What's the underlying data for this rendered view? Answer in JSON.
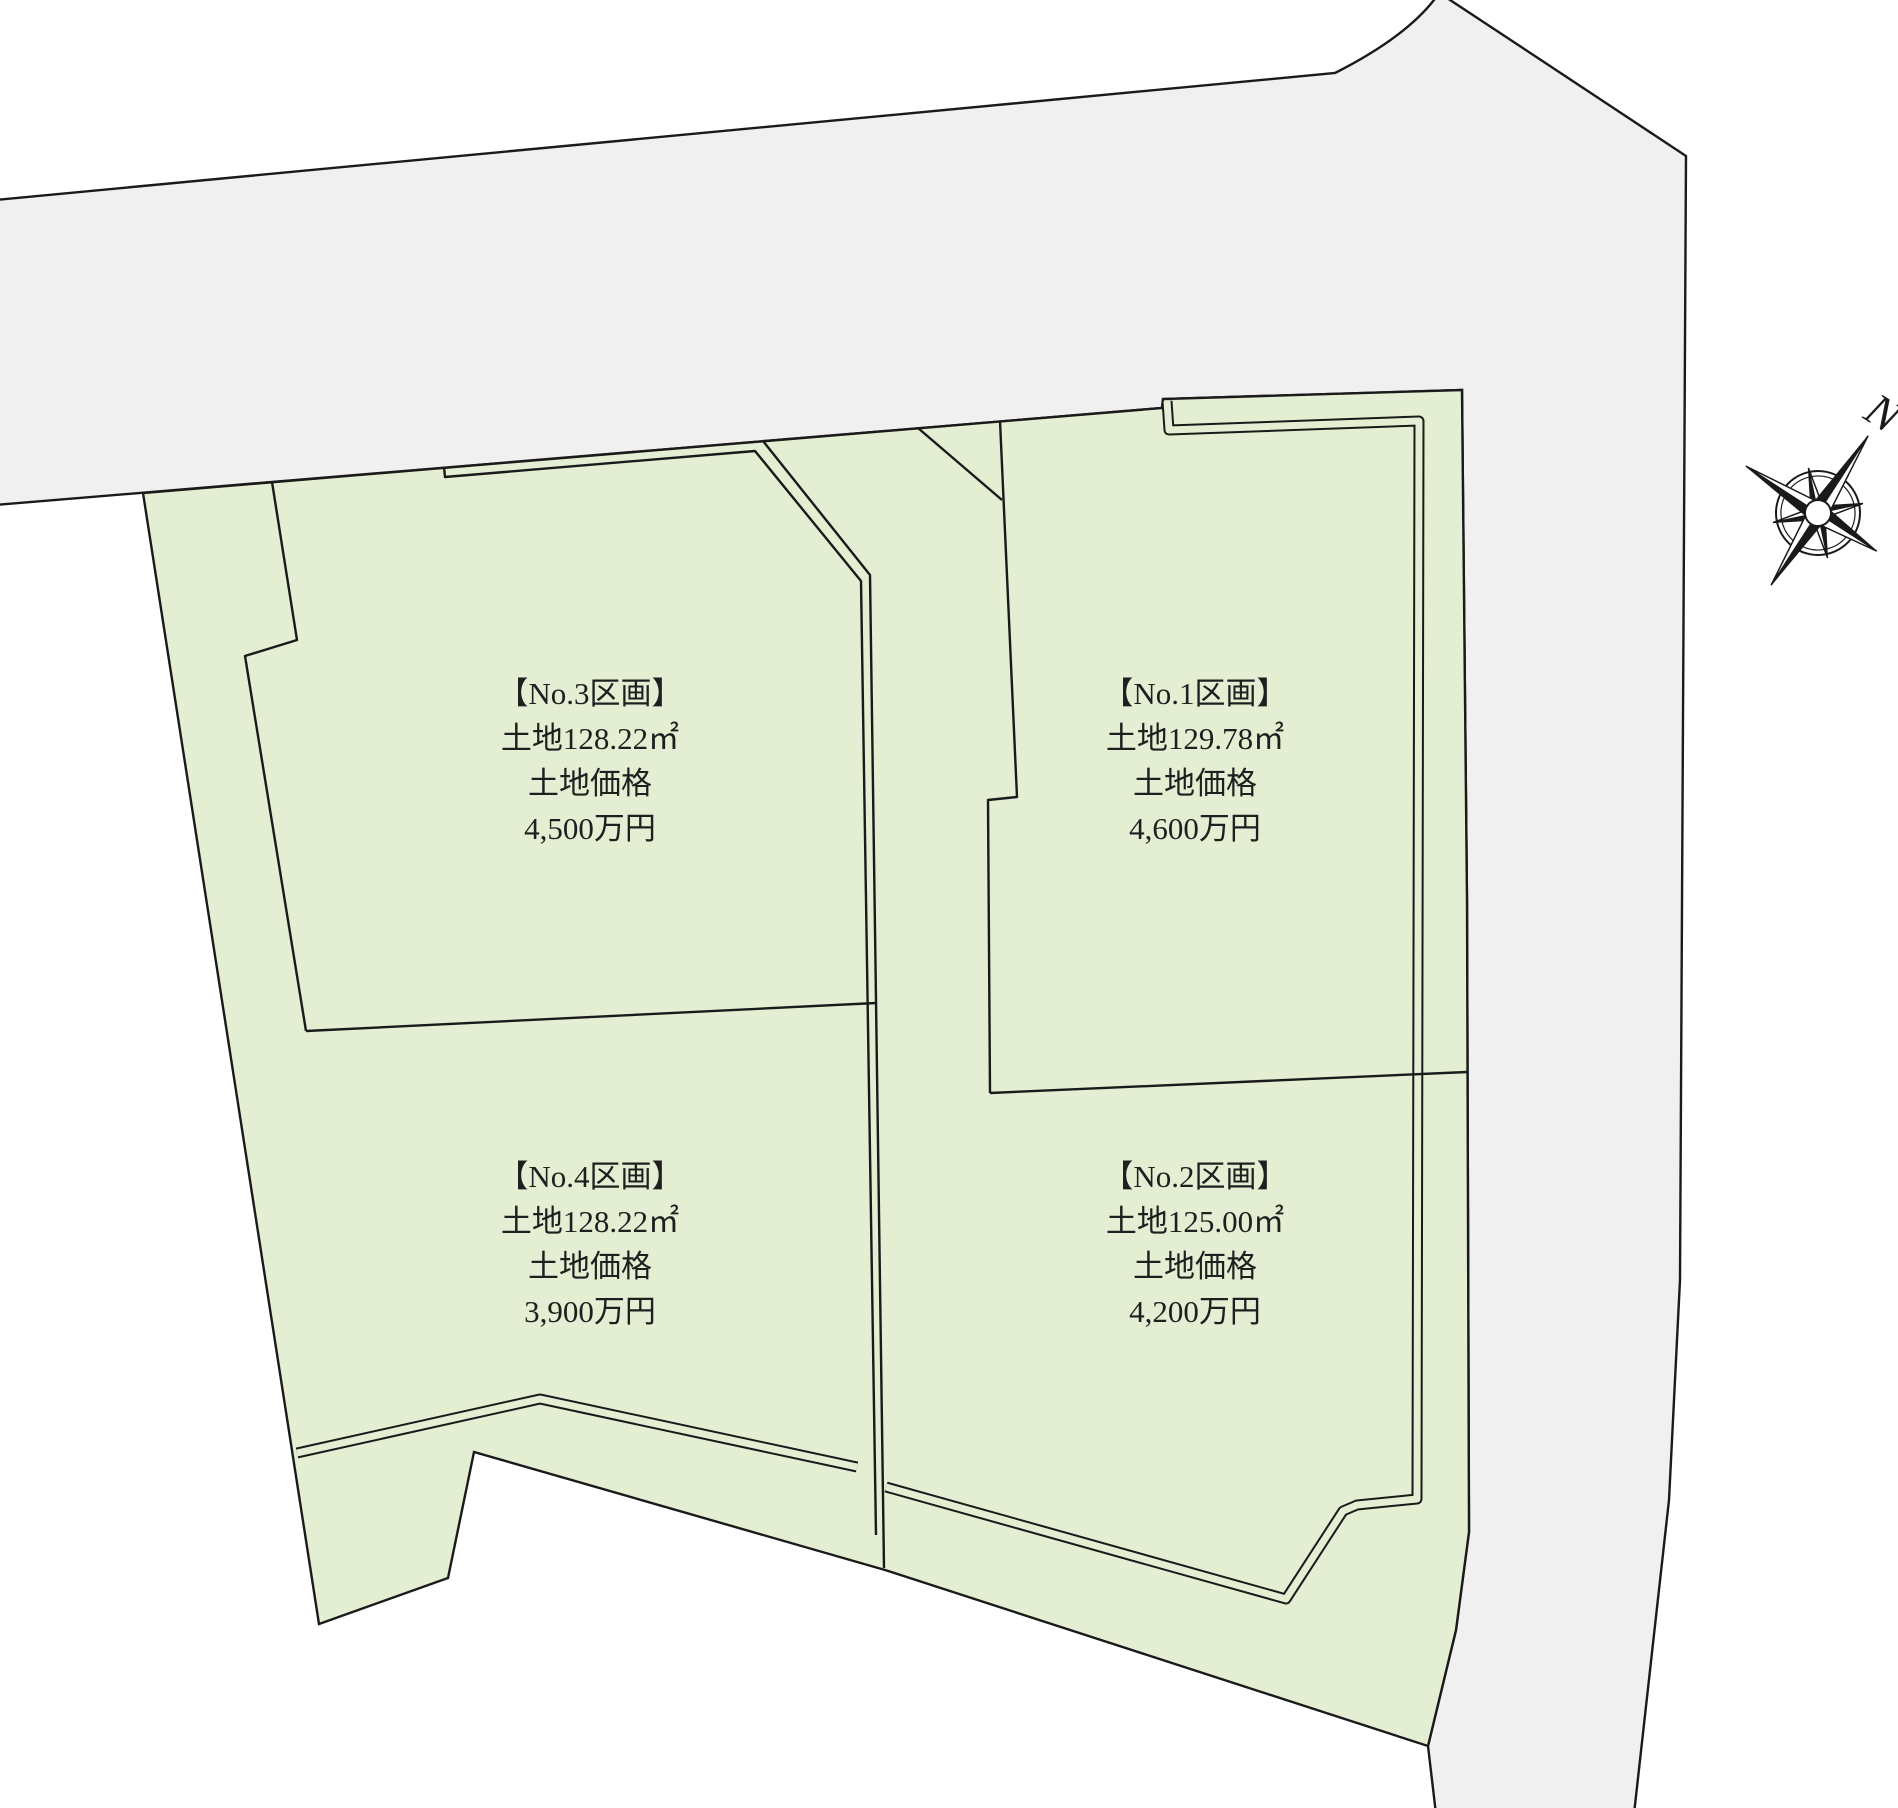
{
  "title": "土地区画図",
  "colors": {
    "road": "#f0f0f0",
    "parcel": "#e4eed2",
    "line": "#1a1a1a",
    "text": "#1f1f1f"
  },
  "compass": {
    "label": "N"
  },
  "parcels": [
    {
      "id": "no3",
      "name": "【No.3区画】",
      "area": "土地128.22㎡",
      "price_label": "土地価格",
      "price": "4,500万円"
    },
    {
      "id": "no1",
      "name": "【No.1区画】",
      "area": "土地129.78㎡",
      "price_label": "土地価格",
      "price": "4,600万円"
    },
    {
      "id": "no4",
      "name": "【No.4区画】",
      "area": "土地128.22㎡",
      "price_label": "土地価格",
      "price": "3,900万円"
    },
    {
      "id": "no2",
      "name": "【No.2区画】",
      "area": "土地125.00㎡",
      "price_label": "土地価格",
      "price": "4,200万円"
    }
  ],
  "geometry": {
    "road": "M -5 200 L 1335 73 Q 1408 36 1437 -4 L 1444 -4 L 1550 66 L 1686 156 L 1680 1280 L 1669 1500 L 1634 1814 L 1436 1814 L 1428 1746 L 1456 1630 L 1469 1532 L 1467 900 L 1462 390 L 1163 399 L 1162 408 L -5 505 Z",
    "estate": "M 143 493 L 319 1624 L 448 1578 L 474 1452 L 885 1570 L 1428 1746 L 1456 1630 L 1469 1532 L 1467 900 L 1462 390 L 1163 399 L 1162 408 Z",
    "plot3_left": "M 272 482 L 297 640 L 245 656 L 306 1031",
    "divider_3_4": "M 306 1031 L 876 1003",
    "mid_boundary": "M 763 441 L 870 575 L 884 1568",
    "setback_left": "M 444 467 L 445 477 L 755 451 L 861 581 L 876 1535",
    "plot1_left": "M 1000 421 L 1017 797 L 988 800 L 990 1093",
    "corner_cut": "M 918 428 L 1002 500",
    "divider_1_2": "M 990 1093 L 1467 1072",
    "setback_right": "M 1167 401 L 1169 430 L 1419 421 L 1417 1499 L 1357 1505 L 1343 1511 L 1286 1599 L 886 1487",
    "setback_bottom_left": "M 297 1453 L 540 1399 L 857 1467"
  }
}
